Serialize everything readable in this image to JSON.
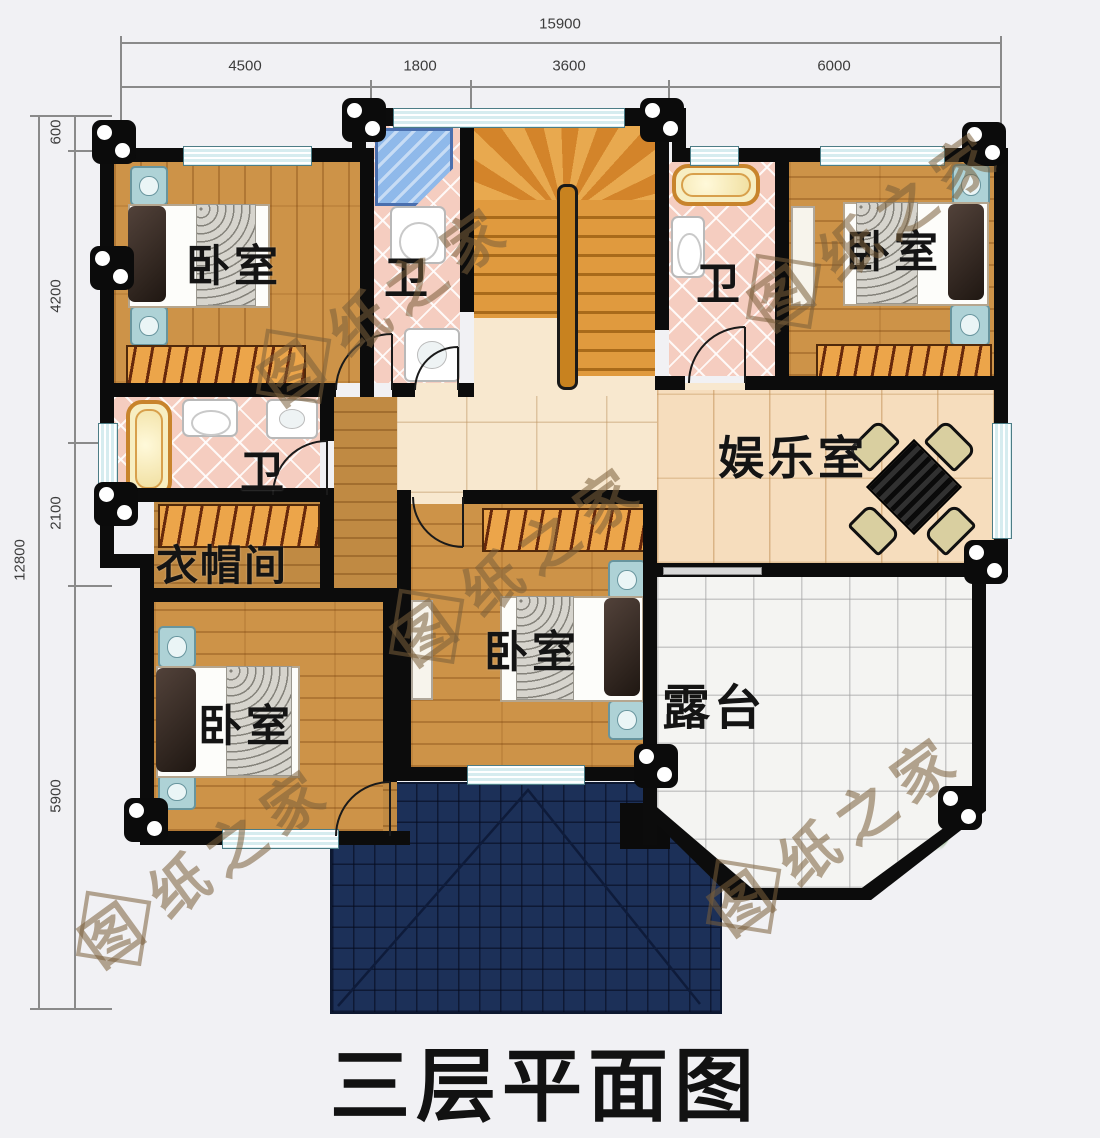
{
  "title": "三层平面图",
  "watermark": "图纸之家",
  "watermark_first": "图",
  "watermark_rest": "纸之家",
  "dimensions": {
    "top": {
      "total": "15900",
      "segments": [
        "4500",
        "1800",
        "3600",
        "6000"
      ]
    },
    "left": {
      "total": "12800",
      "segments": [
        "600",
        "4200",
        "2100",
        "5900"
      ]
    }
  },
  "rooms": {
    "bedroom_top_left": "卧室",
    "bath_top_middle": "卫",
    "bath_top_right": "卫",
    "bedroom_top_right": "卧室",
    "bath_left": "卫",
    "cloakroom": "衣帽间",
    "entertainment": "娱乐室",
    "bedroom_center": "卧室",
    "bedroom_bottom_left": "卧室",
    "terrace": "露台"
  },
  "colors": {
    "wall": "#0c0c0c",
    "wood_floor": "#cd9348",
    "hall_floor": "#f8e8cf",
    "bath_tile": "#f5cdc0",
    "window": "#d6ecef",
    "roof": "#1c3058",
    "terrace_tile": "#f4f4f2",
    "plant_green": "#4f9c2e",
    "umbrella_pink": "#dfb9bc",
    "stair_wood": "#dd8f33",
    "table_yellow": "#e8a820"
  }
}
